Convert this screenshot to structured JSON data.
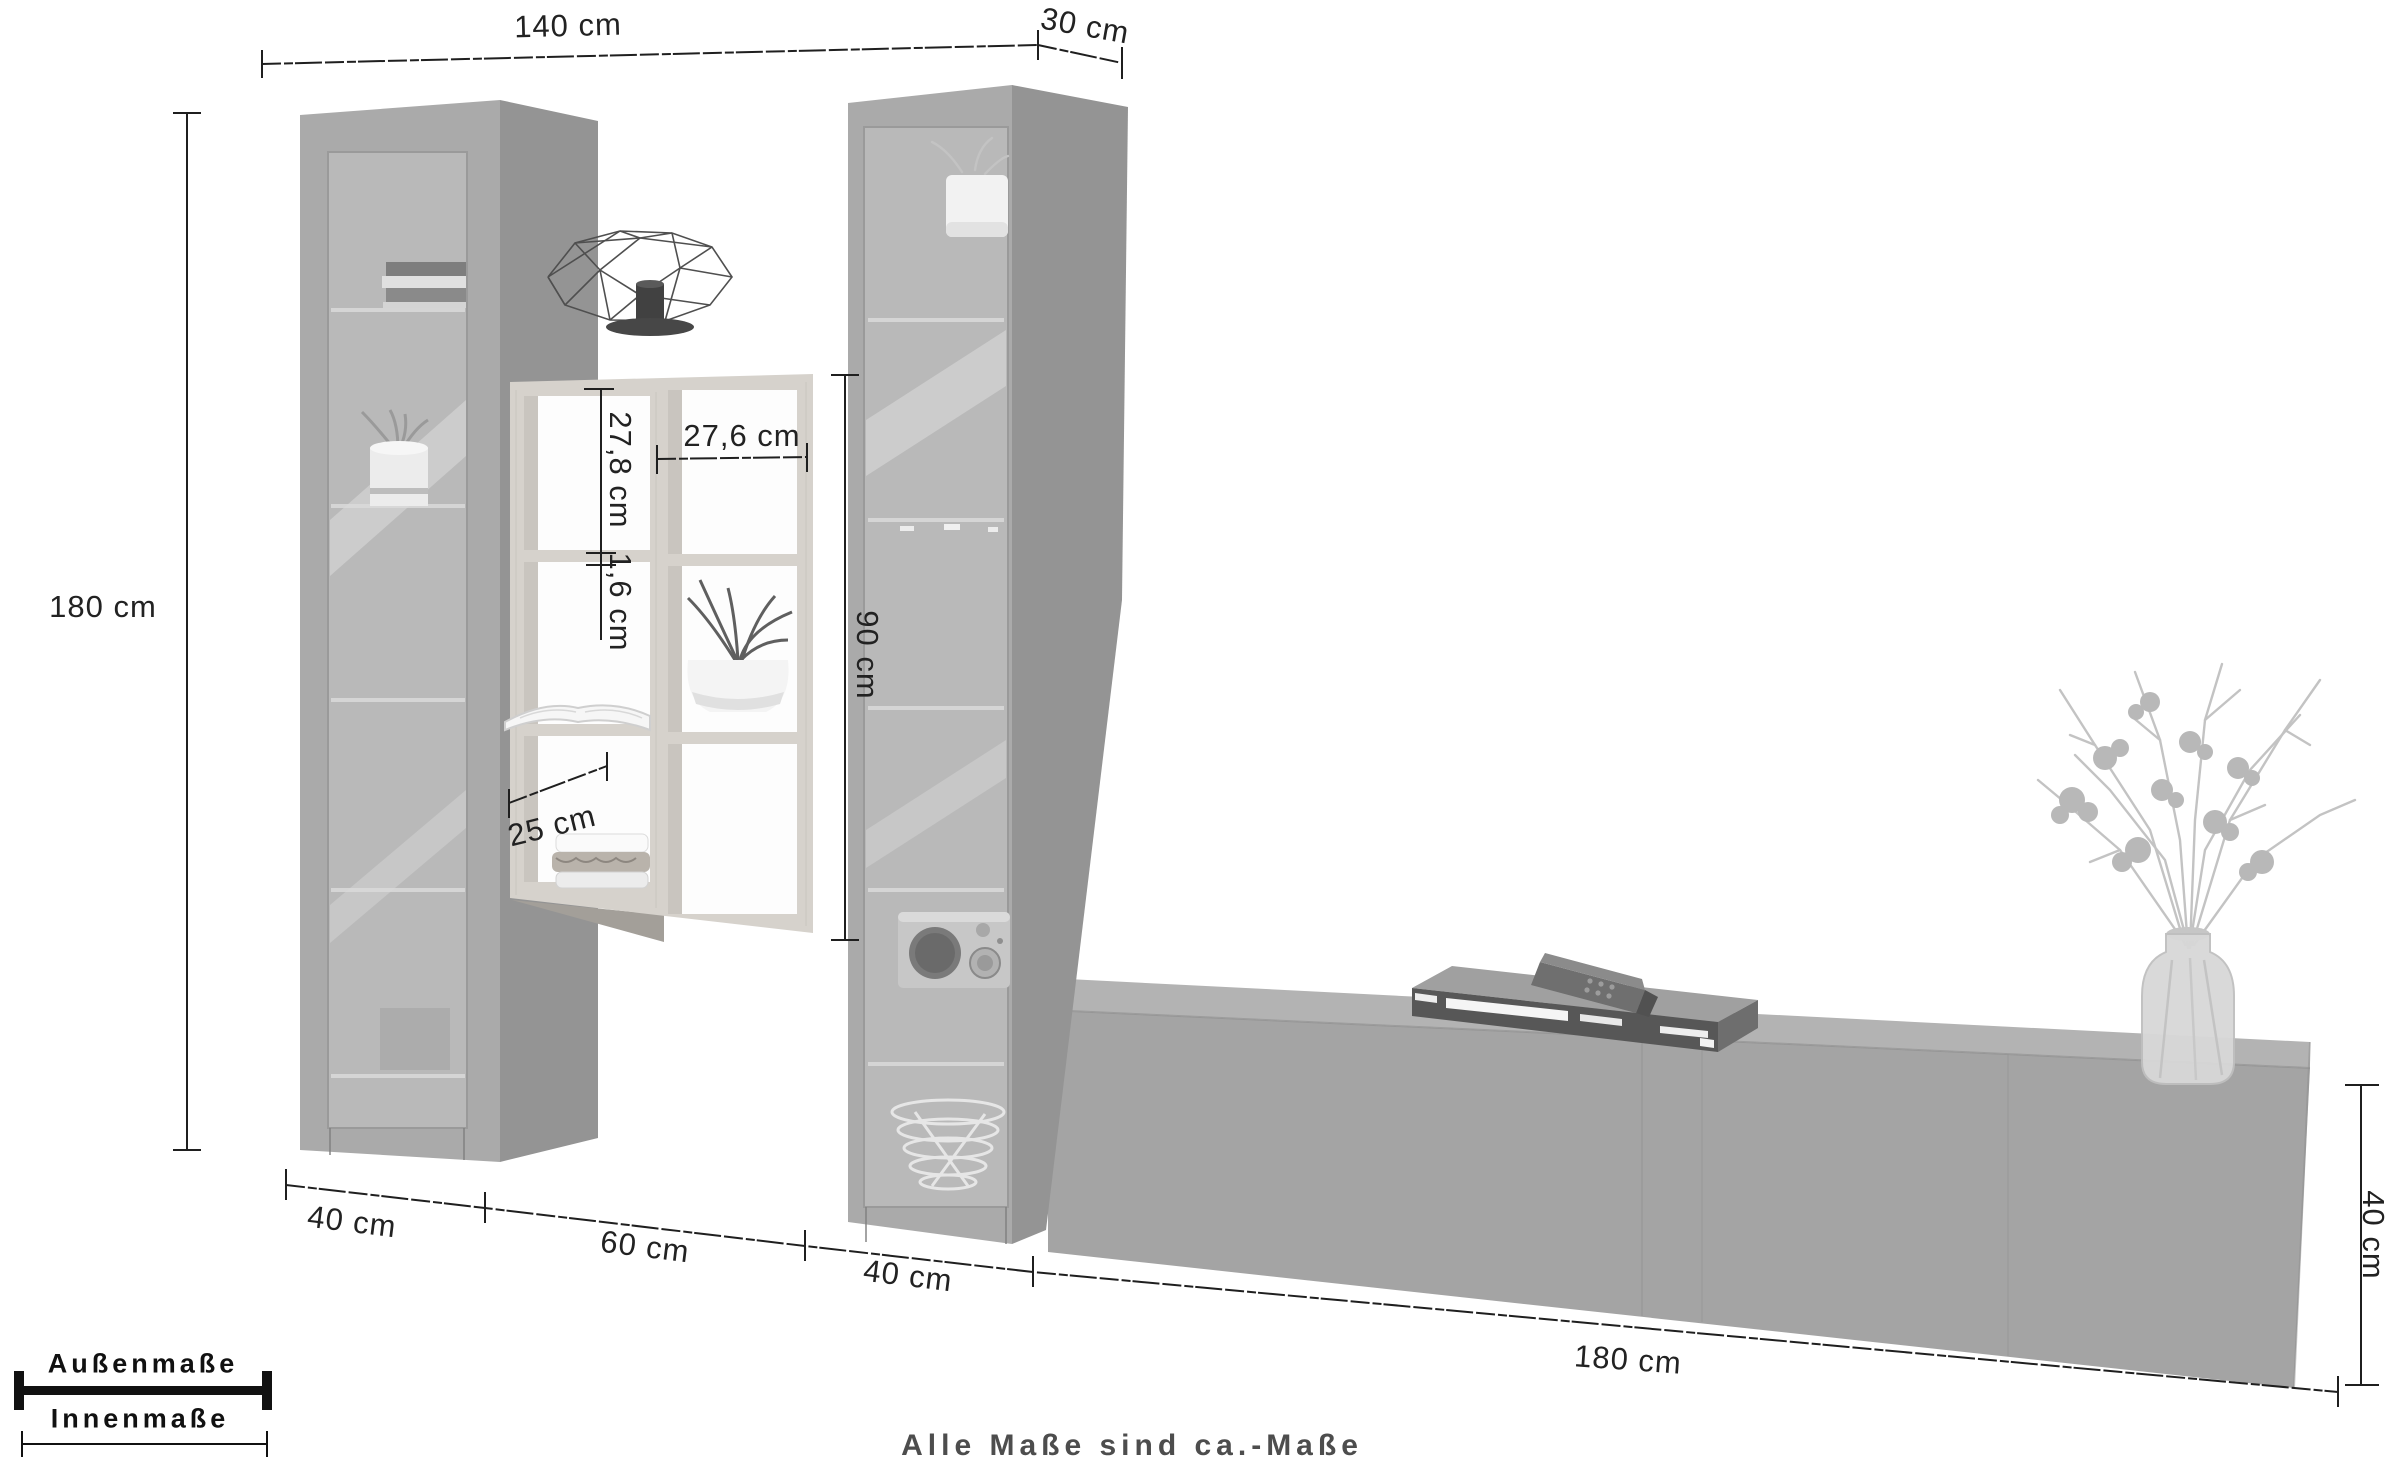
{
  "labels": {
    "top_width": "140 cm",
    "top_depth": "30 cm",
    "height_left": "180 cm",
    "inner_cell_height": "27,8 cm",
    "inner_cell_width": "27,6 cm",
    "shelf_thickness": "1,6 cm",
    "shelf_unit_height": "90 cm",
    "inner_bottom_width": "25 cm",
    "bottom_width_1": "40 cm",
    "bottom_width_2": "60 cm",
    "bottom_width_3": "40 cm",
    "bottom_width_4": "180 cm",
    "lowboard_height": "40 cm"
  },
  "legend": {
    "outer": "Außenmaße",
    "inner": "Innenmaße"
  },
  "caption": "Alle Maße sind ca.-Maße",
  "colors": {
    "line": "#1f1f1f",
    "cabinet_front": "#aaaaaa",
    "cabinet_side": "#949494",
    "glass": "#b9b9b9",
    "wood": "#d6d2cc",
    "lowboard_front": "#a4a4a4",
    "lowboard_top": "#b3b3b3",
    "caption_text": "#4d4d4d"
  }
}
